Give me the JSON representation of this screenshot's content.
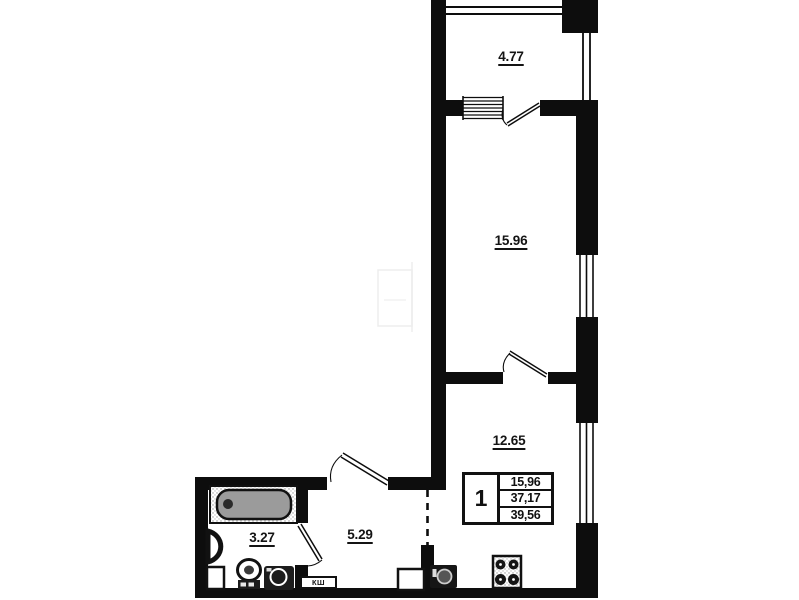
{
  "rooms": {
    "balcony": "4.77",
    "living": "15.96",
    "kitchen_living": "12.65",
    "hallway": "5.29",
    "bathroom": "3.27"
  },
  "stamp": {
    "room_count": "1",
    "living_area": "15,96",
    "apartment_area": "37,17",
    "total_area": "39,56"
  },
  "labels": {
    "duct": "КШ"
  },
  "colors": {
    "wall": "#0d0d0d",
    "tub_fill": "#9b9b9b",
    "background": "#ffffff"
  },
  "fixtures": [
    "bathtub",
    "wash-basin",
    "toilet",
    "washing-machine",
    "kitchen-sink",
    "stove",
    "duct-box"
  ]
}
